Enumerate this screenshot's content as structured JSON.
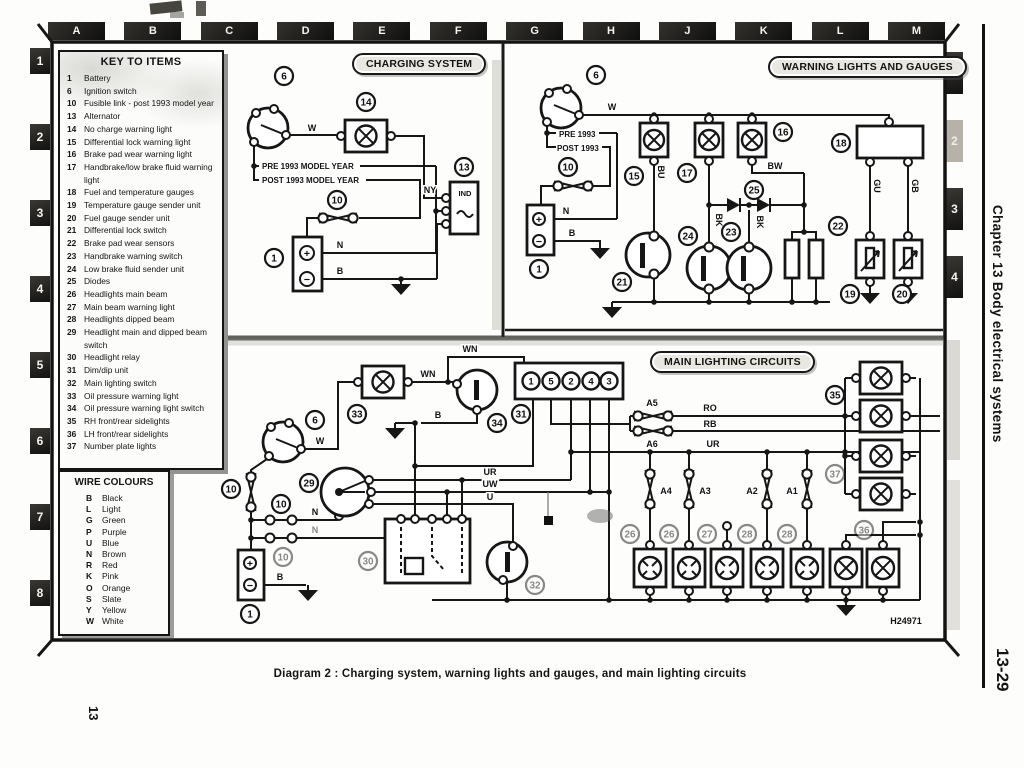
{
  "page": {
    "caption": "Diagram 2 : Charging system, warning lights and gauges, and main lighting circuits",
    "chapter_vertical": "Chapter 13 Body electrical systems",
    "page_ref_vertical": "13-29",
    "page_num_vertical": "13",
    "drawing_ref": "H24971"
  },
  "grid": {
    "columns": [
      "A",
      "B",
      "C",
      "D",
      "E",
      "F",
      "G",
      "H",
      "J",
      "K",
      "L",
      "M"
    ],
    "left_rows": [
      "1",
      "2",
      "3",
      "4",
      "5",
      "6",
      "7",
      "8"
    ],
    "right_rows": [
      "1",
      "2",
      "3",
      "4"
    ]
  },
  "key_to_items": {
    "title": "KEY TO ITEMS",
    "items": [
      {
        "num": "1",
        "label": "Battery"
      },
      {
        "num": "6",
        "label": "Ignition switch"
      },
      {
        "num": "10",
        "label": "Fusible link - post 1993 model year"
      },
      {
        "num": "13",
        "label": "Alternator"
      },
      {
        "num": "14",
        "label": "No charge warning light"
      },
      {
        "num": "15",
        "label": "Differential lock warning light"
      },
      {
        "num": "16",
        "label": "Brake pad wear warning light"
      },
      {
        "num": "17",
        "label": "Handbrake/low brake fluid warning light"
      },
      {
        "num": "18",
        "label": "Fuel and temperature gauges"
      },
      {
        "num": "19",
        "label": "Temperature gauge sender unit"
      },
      {
        "num": "20",
        "label": "Fuel gauge sender unit"
      },
      {
        "num": "21",
        "label": "Differential lock switch"
      },
      {
        "num": "22",
        "label": "Brake pad wear sensors"
      },
      {
        "num": "23",
        "label": "Handbrake warning switch"
      },
      {
        "num": "24",
        "label": "Low brake fluid sender unit"
      },
      {
        "num": "25",
        "label": "Diodes"
      },
      {
        "num": "26",
        "label": "Headlights main beam"
      },
      {
        "num": "27",
        "label": "Main beam warning light"
      },
      {
        "num": "28",
        "label": "Headlights dipped beam"
      },
      {
        "num": "29",
        "label": "Headlight main and dipped beam switch"
      },
      {
        "num": "30",
        "label": "Headlight relay"
      },
      {
        "num": "31",
        "label": "Dim/dip unit"
      },
      {
        "num": "32",
        "label": "Main lighting switch"
      },
      {
        "num": "33",
        "label": "Oil pressure warning light"
      },
      {
        "num": "34",
        "label": "Oil pressure warning light switch"
      },
      {
        "num": "35",
        "label": "RH front/rear sidelights"
      },
      {
        "num": "36",
        "label": "LH front/rear sidelights"
      },
      {
        "num": "37",
        "label": "Number plate lights"
      }
    ]
  },
  "wire_colours": {
    "title": "WIRE COLOURS",
    "entries": [
      {
        "code": "B",
        "name": "Black"
      },
      {
        "code": "L",
        "name": "Light"
      },
      {
        "code": "G",
        "name": "Green"
      },
      {
        "code": "P",
        "name": "Purple"
      },
      {
        "code": "U",
        "name": "Blue"
      },
      {
        "code": "N",
        "name": "Brown"
      },
      {
        "code": "R",
        "name": "Red"
      },
      {
        "code": "K",
        "name": "Pink"
      },
      {
        "code": "O",
        "name": "Orange"
      },
      {
        "code": "S",
        "name": "Slate"
      },
      {
        "code": "Y",
        "name": "Yellow"
      },
      {
        "code": "W",
        "name": "White"
      }
    ]
  },
  "sections": {
    "charging": {
      "title": "CHARGING SYSTEM",
      "pre_label": "PRE 1993 MODEL YEAR",
      "post_label": "POST 1993 MODEL YEAR",
      "alt_terminal": "IND",
      "plus": "+",
      "minus": "−",
      "wires": {
        "w": "W",
        "ny": "NY",
        "n": "N",
        "b": "B"
      },
      "callouts": {
        "ignition": "6",
        "warning_light": "14",
        "alternator": "13",
        "fusible_link": "10",
        "battery": "1"
      }
    },
    "warning": {
      "title": "WARNING LIGHTS AND GAUGES",
      "pre_label": "PRE 1993",
      "post_label": "POST 1993",
      "plus": "+",
      "minus": "−",
      "wires": {
        "w": "W",
        "n": "N",
        "b": "B",
        "bu": "BU",
        "bk": "BK",
        "bw": "BW",
        "gu": "GU",
        "gb": "GB"
      },
      "callouts": {
        "ignition": "6",
        "fusible_link": "10",
        "battery": "1",
        "diff_lock_light": "15",
        "brake_pad_light": "16",
        "handbrake_light": "17",
        "gauges": "18",
        "temp_sender": "19",
        "fuel_sender": "20",
        "diff_lock_switch": "21",
        "brake_pad_sensors": "22",
        "handbrake_switch": "23",
        "low_fluid_sender": "24",
        "diodes": "25"
      }
    },
    "lighting": {
      "title": "MAIN LIGHTING CIRCUITS",
      "plus": "+",
      "minus": "−",
      "wires": {
        "wn": "WN",
        "w": "W",
        "b": "B",
        "n": "N",
        "ur": "UR",
        "uw": "UW",
        "u": "U",
        "ro": "RO",
        "rb": "RB"
      },
      "fuses": {
        "a1": "A1",
        "a2": "A2",
        "a3": "A3",
        "a4": "A4",
        "a5": "A5",
        "a6": "A6"
      },
      "connector_terminals": [
        "1",
        "5",
        "2",
        "4",
        "3"
      ],
      "callouts": {
        "oil_light": "33",
        "oil_switch": "34",
        "ignition": "6",
        "beam_switch": "29",
        "fusible_link": "10",
        "battery": "1",
        "dim_dip": "31",
        "relay": "30",
        "main_switch": "32",
        "rh_sidelights": "35",
        "lh_sidelights": "36",
        "number_plate": "37",
        "main_beam": "26",
        "beam_warning": "27",
        "dipped": "28"
      }
    }
  }
}
